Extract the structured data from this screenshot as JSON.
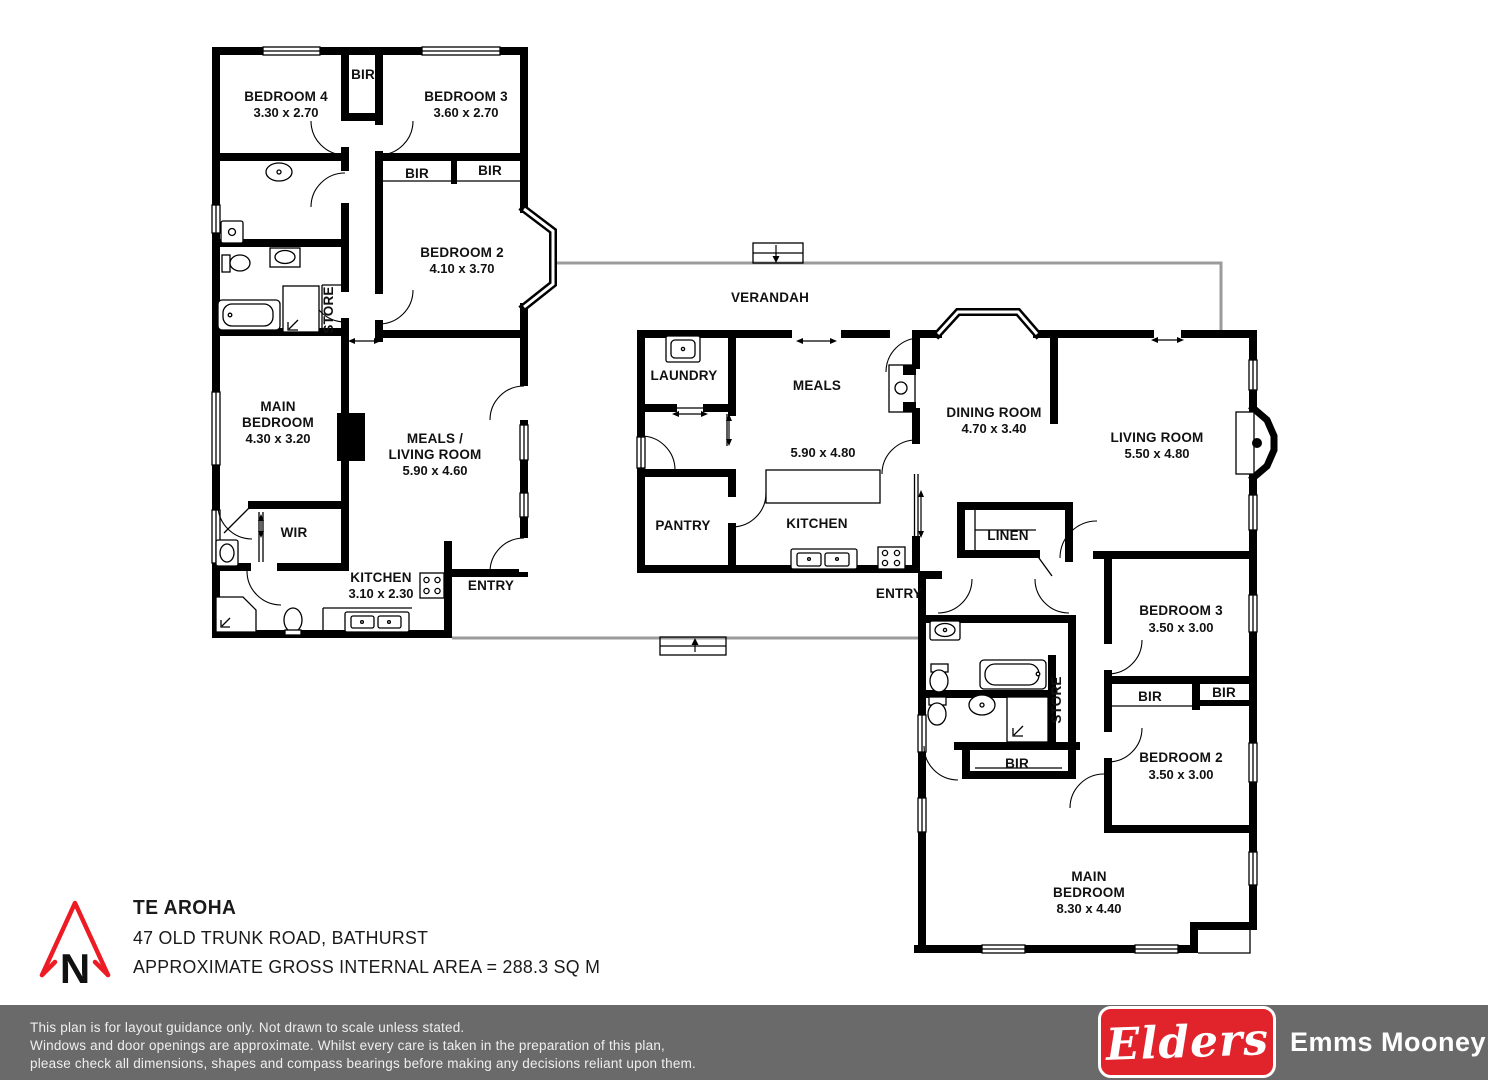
{
  "labels": {
    "a_bed4_name": "BEDROOM 4",
    "a_bed4_dims": "3.30 x 2.70",
    "a_bir_top": "BIR",
    "a_bed3_name": "BEDROOM 3",
    "a_bed3_dims": "3.60 x 2.70",
    "a_bir_1": "BIR",
    "a_bir_2": "BIR",
    "a_bed2_name": "BEDROOM 2",
    "a_bed2_dims": "4.10 x 3.70",
    "a_store": "STORE",
    "a_main_1": "MAIN",
    "a_main_2": "BEDROOM",
    "a_main_dims": "4.30 x 3.20",
    "a_meals_1": "MEALS /",
    "a_meals_2": "LIVING ROOM",
    "a_meals_dims": "5.90 x 4.60",
    "a_wir": "WIR",
    "a_kitchen_name": "KITCHEN",
    "a_kitchen_dims": "3.10 x 2.30",
    "a_entry": "ENTRY",
    "verandah": "VERANDAH",
    "b_laundry": "LAUNDRY",
    "b_meals": "MEALS",
    "b_meals_dims": "5.90 x 4.80",
    "b_pantry": "PANTRY",
    "b_kitchen": "KITCHEN",
    "b_dining_name": "DINING ROOM",
    "b_dining_dims": "4.70 x 3.40",
    "b_linen": "LINEN",
    "b_living_name": "LIVING ROOM",
    "b_living_dims": "5.50 x 4.80",
    "c_entry": "ENTRY",
    "c_bed3_name": "BEDROOM 3",
    "c_bed3_dims": "3.50 x 3.00",
    "c_bir_1": "BIR",
    "c_bir_2": "BIR",
    "c_bir_3": "BIR",
    "c_store": "STORE",
    "c_bed2_name": "BEDROOM 2",
    "c_bed2_dims": "3.50 x 3.00",
    "c_main_1": "MAIN",
    "c_main_2": "BEDROOM",
    "c_main_dims": "8.30 x 4.40"
  },
  "title_block": {
    "title": "TE AROHA",
    "address": "47 OLD TRUNK ROAD, BATHURST",
    "area": "APPROXIMATE GROSS INTERNAL AREA = 288.3 SQ M",
    "north_letter": "N"
  },
  "footer": {
    "line1": "This plan is for layout guidance only. Not drawn to scale unless stated.",
    "line2": "Windows and door openings are approximate. Whilst every care is taken in the preparation of this plan,",
    "line3": "please check all dimensions, shapes and compass bearings before making any decisions reliant upon them.",
    "brand": "Elders",
    "agency": "Emms Mooney"
  },
  "colors": {
    "wall": "#000000",
    "vline": "#9b9b9b",
    "bar": "#6a6a6a",
    "red": "#e1232b",
    "nred": "#ed1c24"
  }
}
